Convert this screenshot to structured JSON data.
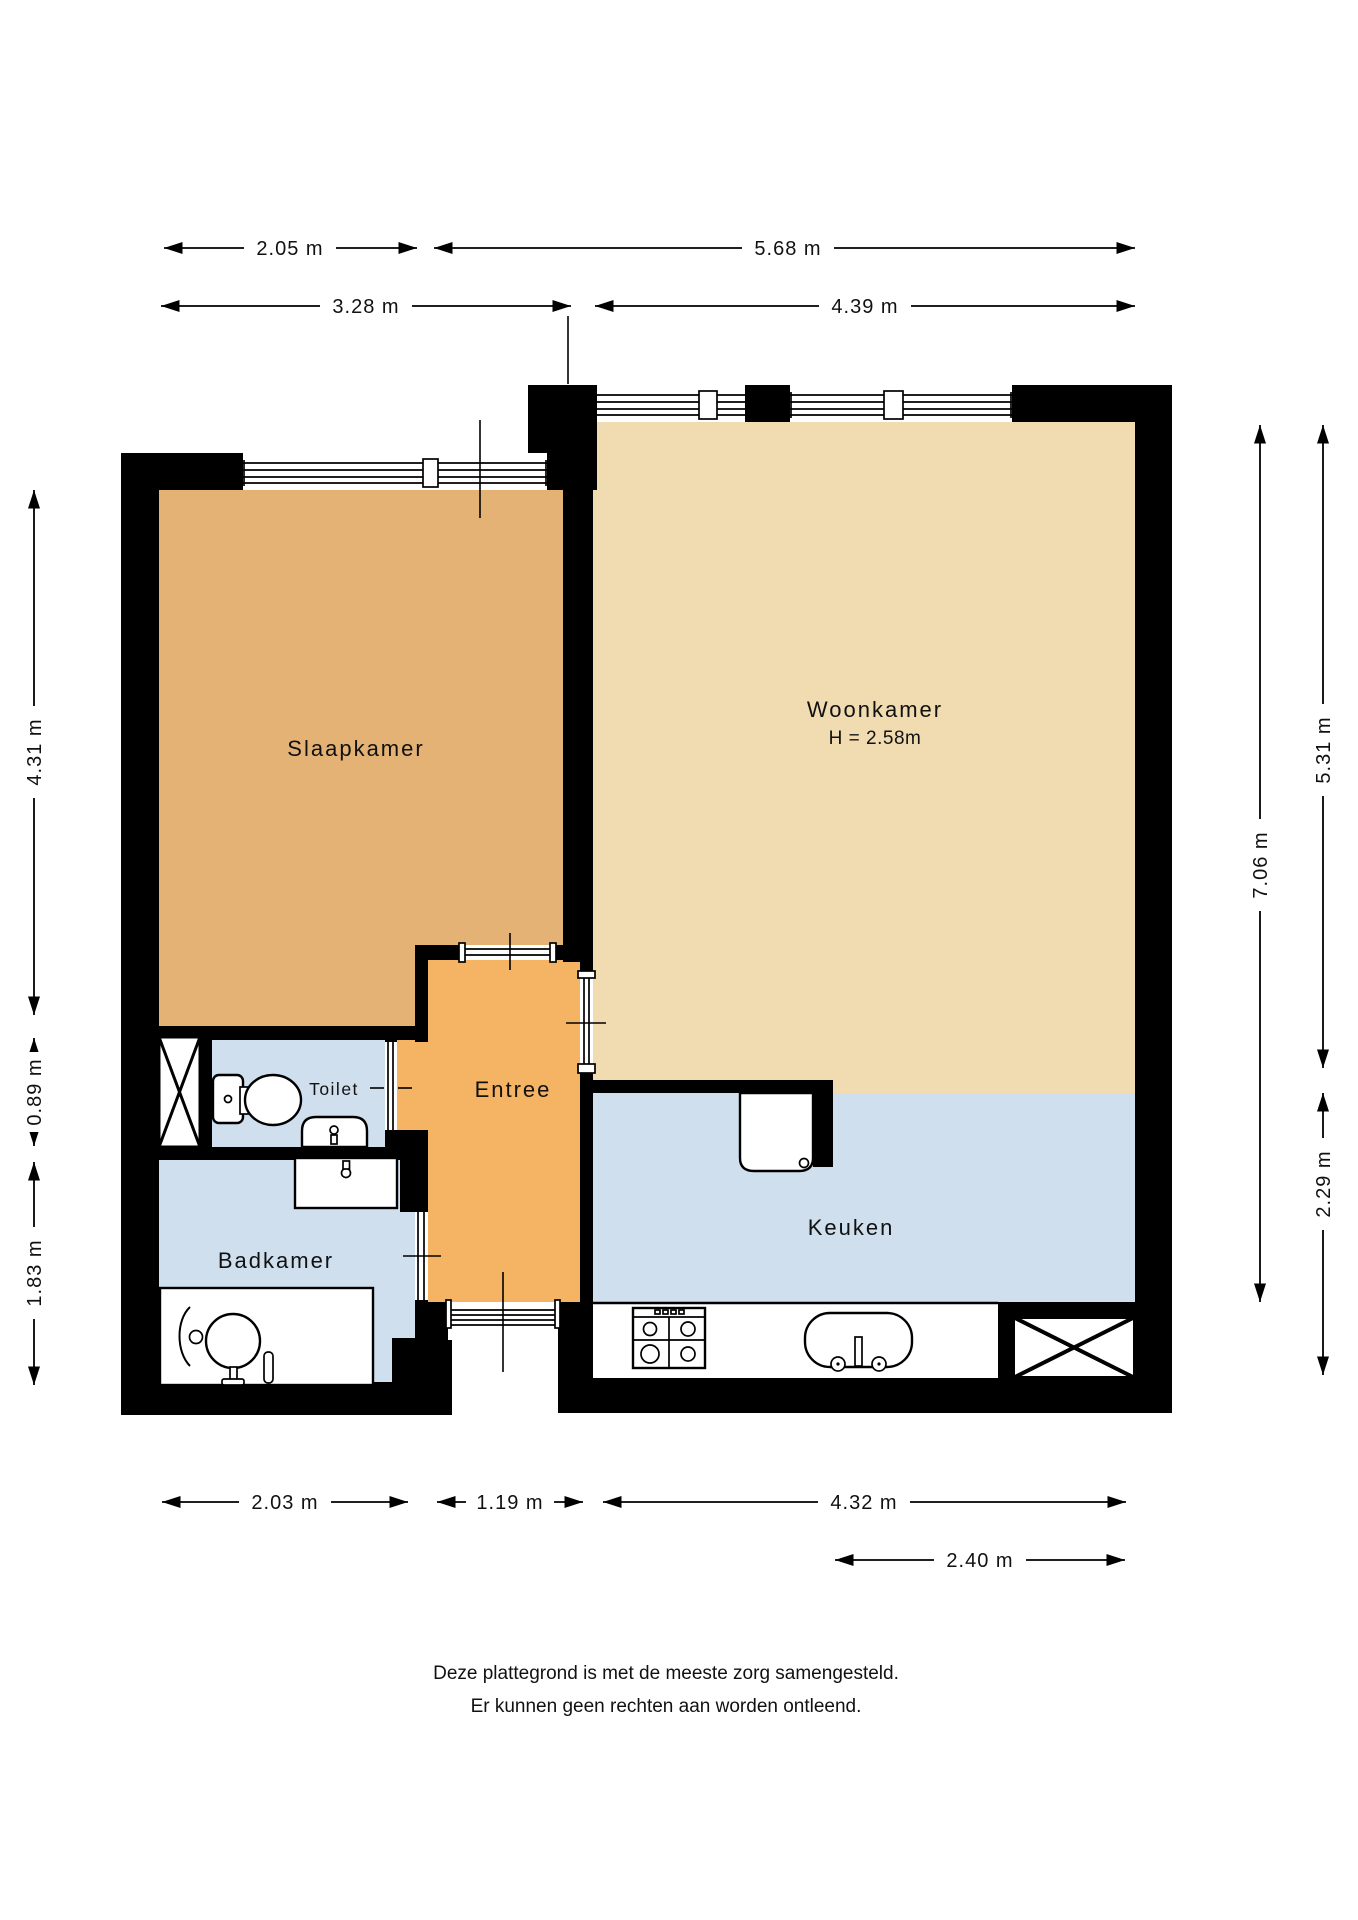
{
  "floorplan": {
    "title": "Plattegrond appartement",
    "colors": {
      "wall": "#000000",
      "slaapkamer_floor": "#e3b274",
      "woonkamer_floor": "#f1dbb1",
      "entree_floor": "#f5b464",
      "wet_room_floor": "#cfdfee",
      "background": "#ffffff"
    },
    "rooms": [
      {
        "id": "slaapkamer",
        "label": "Slaapkamer"
      },
      {
        "id": "woonkamer",
        "label": "Woonkamer",
        "height_note": "H = 2.58m"
      },
      {
        "id": "entree",
        "label": "Entree"
      },
      {
        "id": "toilet",
        "label": "Toilet"
      },
      {
        "id": "badkamer",
        "label": "Badkamer"
      },
      {
        "id": "keuken",
        "label": "Keuken"
      }
    ],
    "fixtures": [
      "toilet",
      "hand-basin",
      "washbasin",
      "pedestal-sink",
      "bath-rail",
      "gas-hob",
      "kitchen-sink",
      "boiler",
      "shaft-cross",
      "shaft-cross"
    ],
    "dimensions": {
      "top_row_1": [
        {
          "label": "2.05 m"
        },
        {
          "label": "5.68 m"
        }
      ],
      "top_row_2": [
        {
          "label": "3.28 m"
        },
        {
          "label": "4.39 m"
        }
      ],
      "bottom_row_1": [
        {
          "label": "2.03 m"
        },
        {
          "label": "1.19 m"
        },
        {
          "label": "4.32 m"
        }
      ],
      "bottom_row_2": [
        {
          "label": "2.40 m"
        }
      ],
      "left": [
        {
          "label": "4.31 m"
        },
        {
          "label": "0.89 m"
        },
        {
          "label": "1.83 m"
        }
      ],
      "right": [
        {
          "label": "7.06 m"
        },
        {
          "label": "5.31 m"
        },
        {
          "label": "2.29 m"
        }
      ]
    },
    "disclaimer": [
      "Deze plattegrond is met de meeste zorg samengesteld.",
      "Er kunnen geen rechten aan worden ontleend."
    ]
  }
}
